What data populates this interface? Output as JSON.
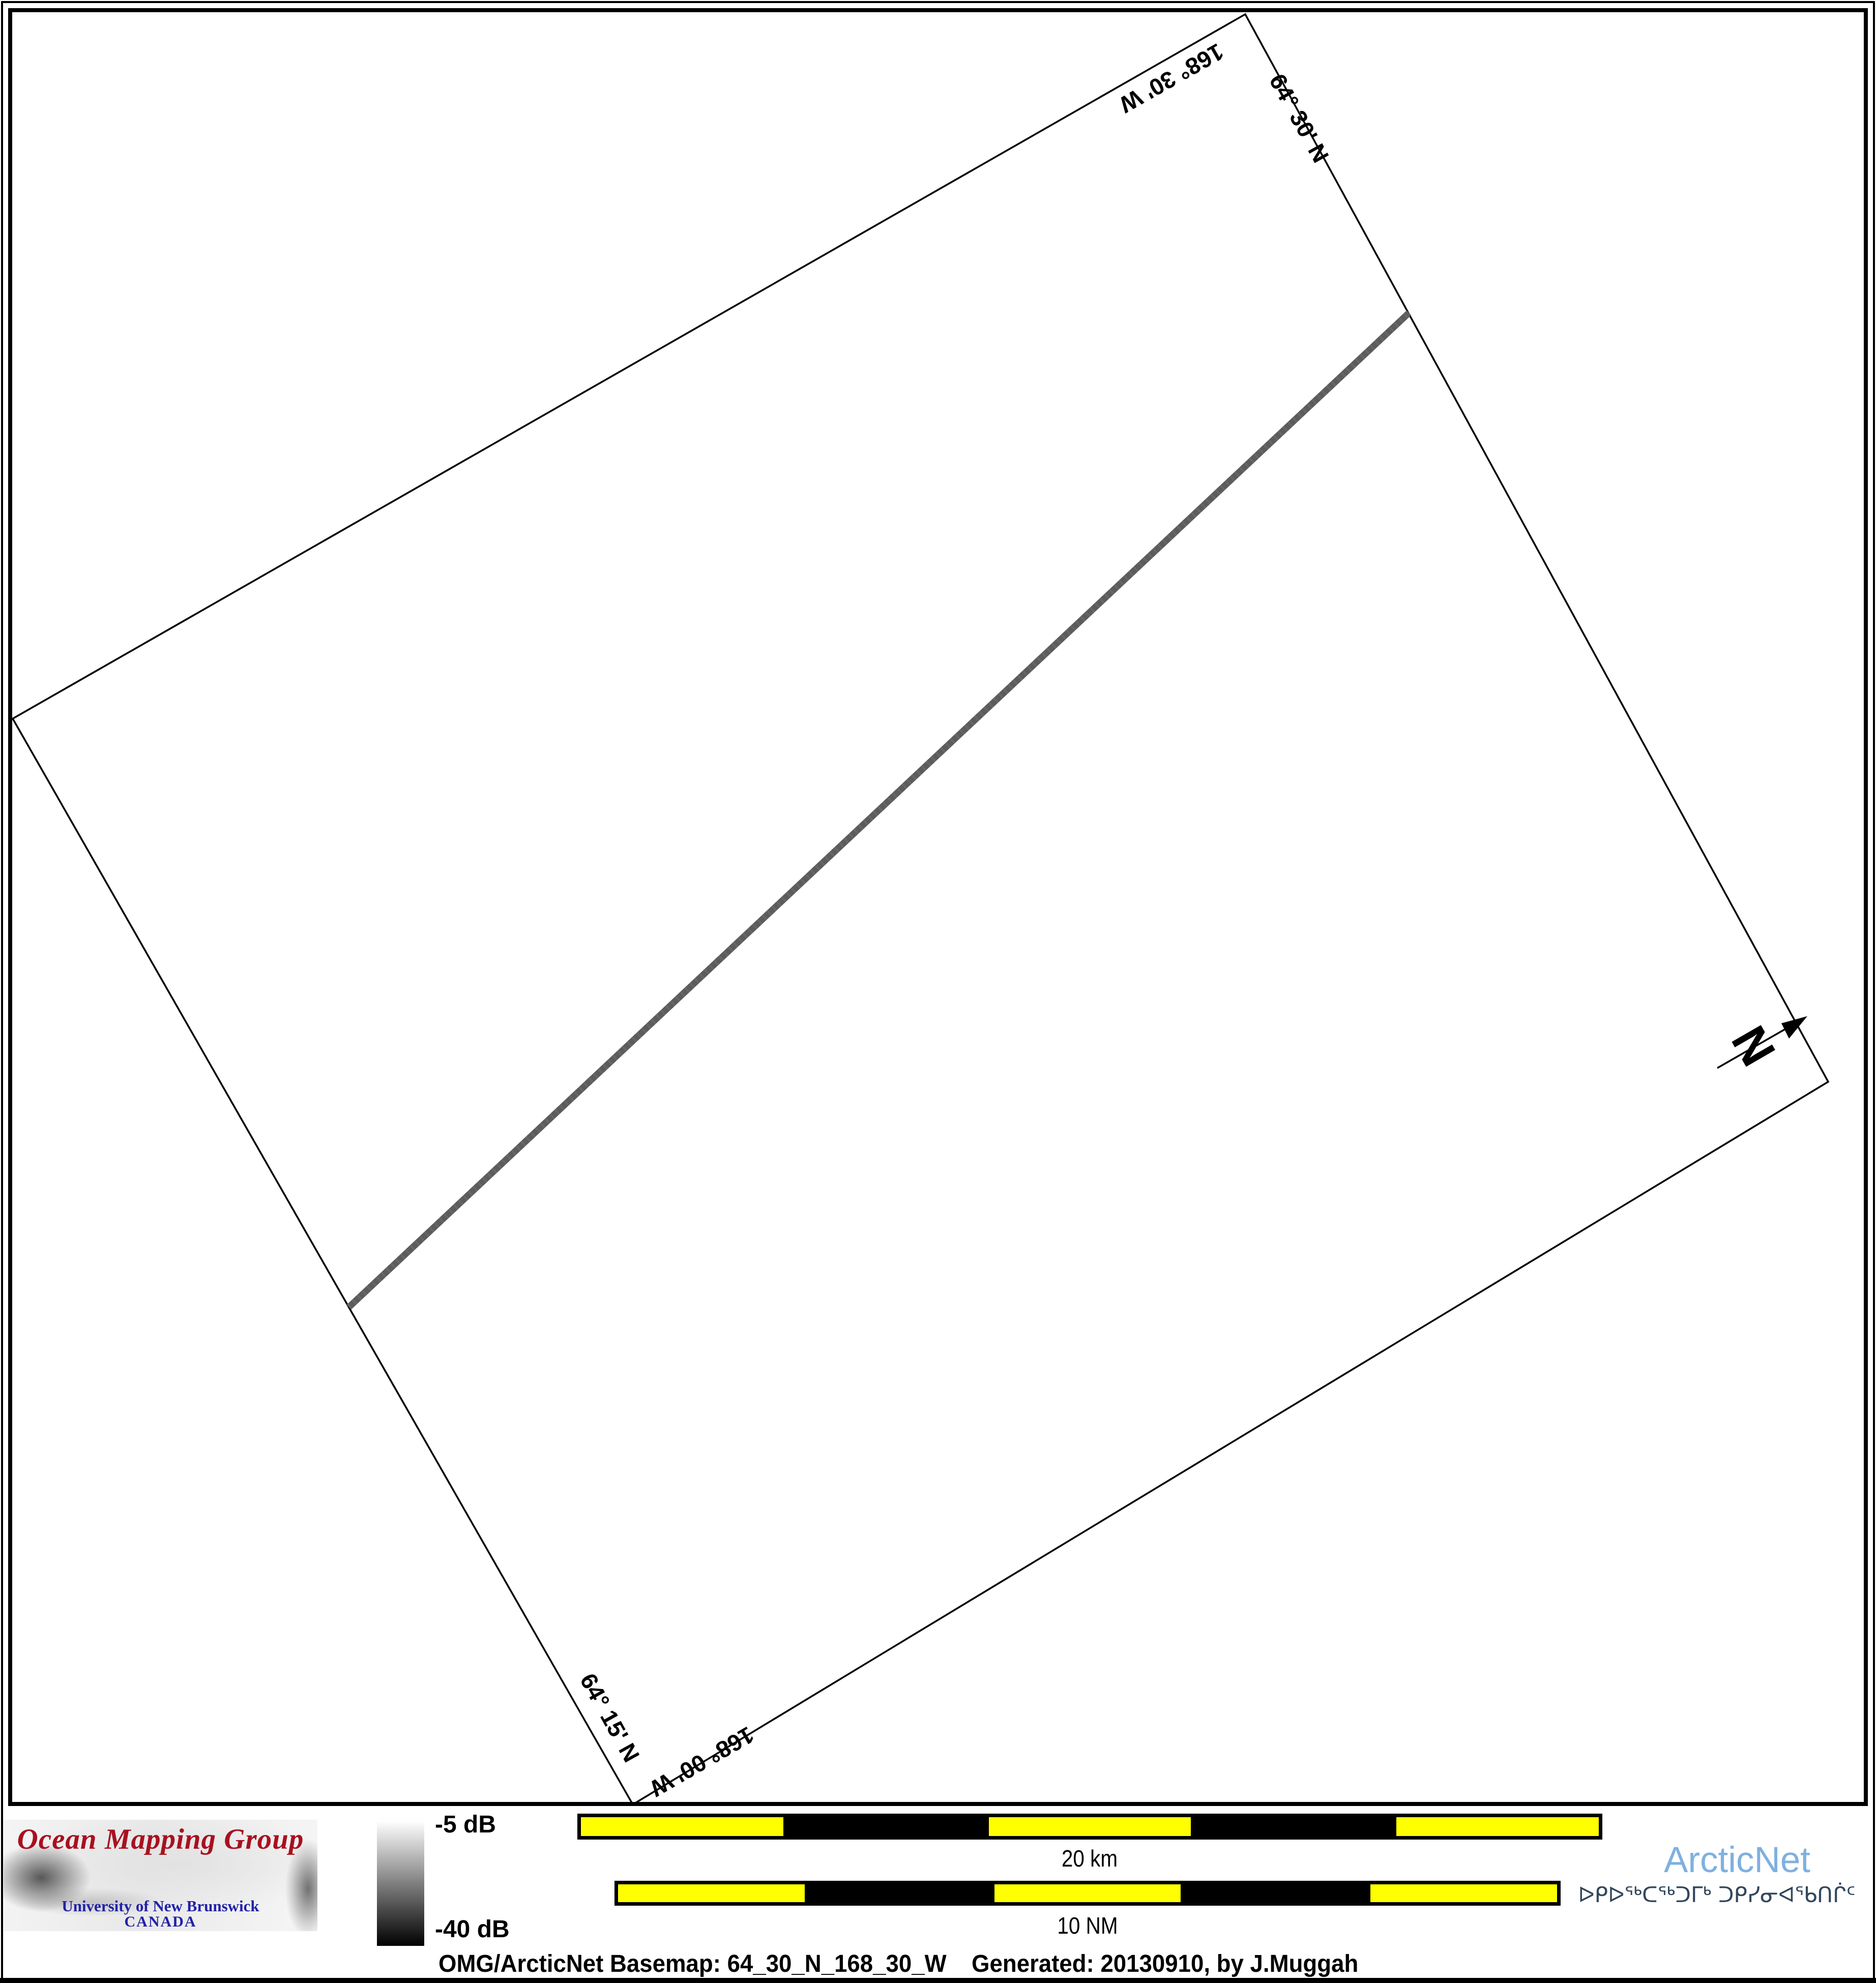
{
  "map": {
    "graticule": {
      "lat_top": "64° 30' N",
      "lon_top": "168° 30' W",
      "lat_bottom": "64° 15' N",
      "lon_bottom": "168° 00' W"
    },
    "north_arrow": {
      "label": "N"
    },
    "track": {
      "color": "#5c5c5c",
      "description": "multibeam survey swath line"
    }
  },
  "legend": {
    "top_label": "-5 dB",
    "bottom_label": "-40 dB",
    "top_color": "#ffffff",
    "bottom_color": "#000000"
  },
  "scalebars": {
    "km": {
      "label": "20 km",
      "segment_count": 5,
      "yellow": "#ffff00",
      "black": "#000000"
    },
    "nm": {
      "label": "10 NM",
      "segment_count": 5,
      "yellow": "#ffff00",
      "black": "#000000"
    }
  },
  "branding": {
    "omg": {
      "title": "Ocean Mapping Group",
      "university": "University of New Brunswick",
      "country": "CANADA",
      "title_color": "#a8101f",
      "text_color": "#2121a8"
    },
    "arcticnet": {
      "name": "ArcticNet",
      "syllabics": "ᐅᑭᐅᖅᑕᖅᑐᒥᒃ ᑐᑭᓯᓂᐊᖃᑎᒌᑦ",
      "name_color": "#7fb0e0",
      "syllabics_color": "#33475c"
    }
  },
  "caption": {
    "basemap": "OMG/ArcticNet Basemap: 64_30_N_168_30_W",
    "generated": "Generated: 20130910, by J.Muggah"
  }
}
